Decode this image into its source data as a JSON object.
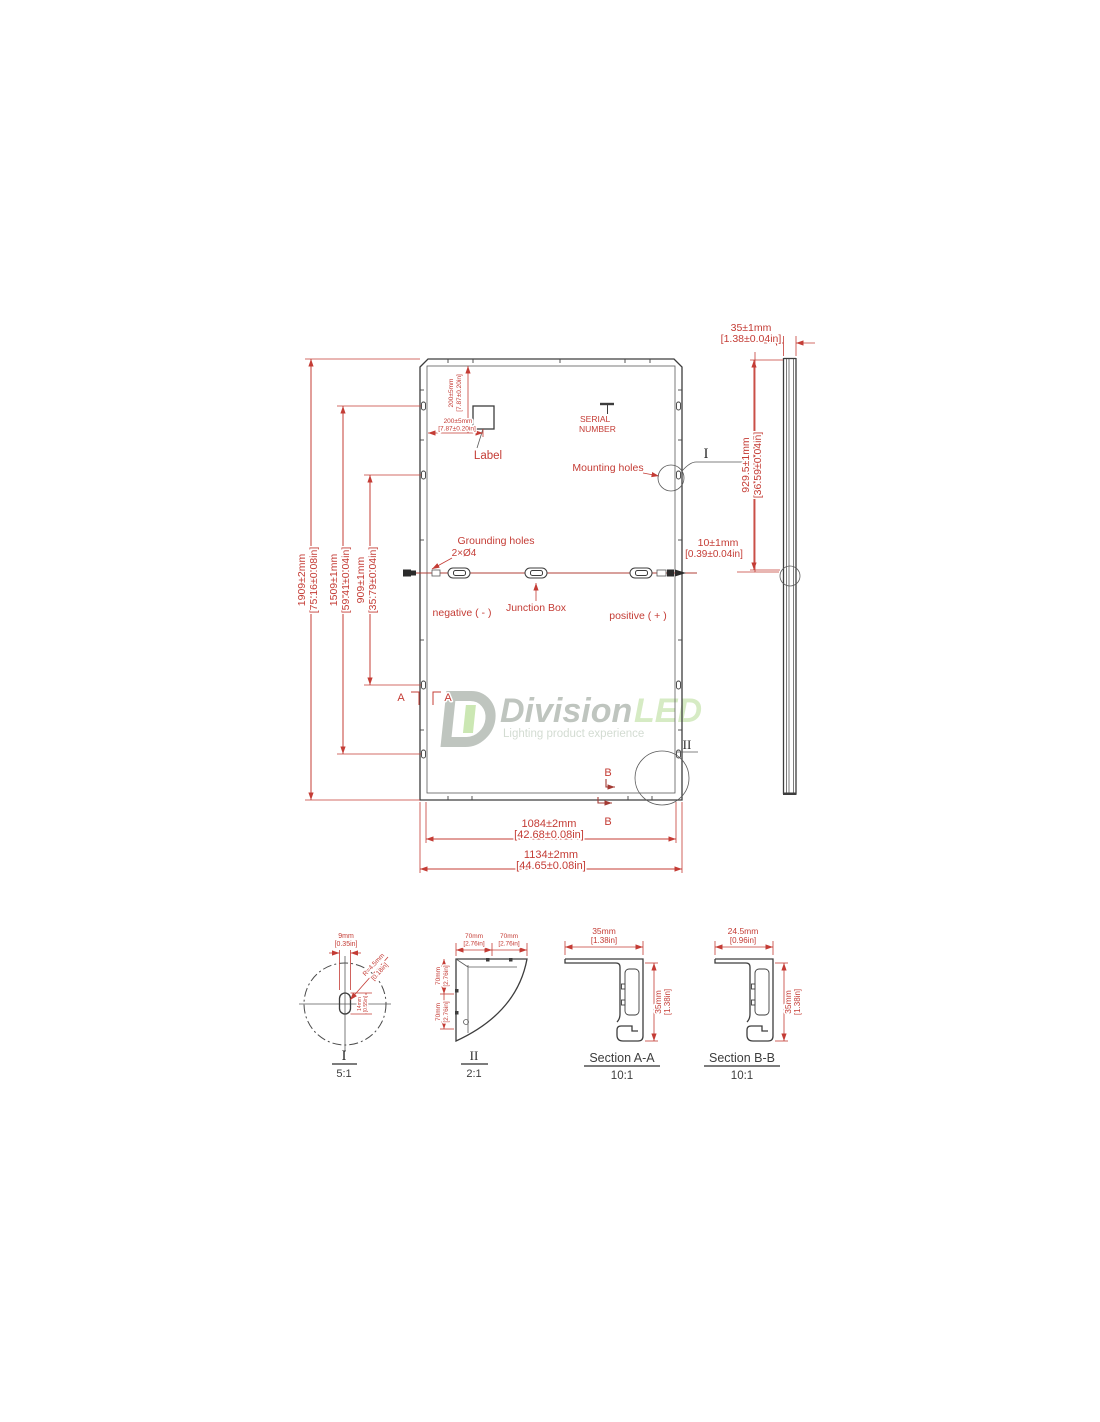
{
  "rear_view": {
    "dims": {
      "height_total_mm": "1909±2mm",
      "height_total_in": "[75.16±0.08in]",
      "height_1509_mm": "1509±1mm",
      "height_1509_in": "[59.41±0.04in]",
      "height_909_mm": "909±1mm",
      "height_909_in": "[35.79±0.04in]",
      "width_total_mm": "1134±2mm",
      "width_total_in": "[44.65±0.08in]",
      "width_inner_mm": "1084±2mm",
      "width_inner_in": "[42.68±0.08in]",
      "label_v_mm": "200±5mm",
      "label_v_in": "[7.87±0.20in]",
      "label_h_mm": "200±5mm",
      "label_h_in": "[7.87±0.20in]",
      "jbox_offset_mm": "10±1mm",
      "jbox_offset_in": "[0.39±0.04in]"
    },
    "labels": {
      "label": "Label",
      "serial_1": "SERIAL",
      "serial_2": "NUMBER",
      "mounting_holes": "Mounting holes",
      "grounding_1": "Grounding holes",
      "grounding_2": "2×Ø4",
      "junction_box": "Junction Box",
      "negative": "negative ( - )",
      "positive": "positive ( + )"
    },
    "markers": {
      "a": "A",
      "b": "B",
      "i": "I",
      "ii": "II"
    }
  },
  "side_view": {
    "thickness_mm": "35±1mm",
    "thickness_in": "[1.38±0.04in]",
    "hole_pos_mm": "929.5±1mm",
    "hole_pos_in": "[36.59±0.04in]"
  },
  "details": {
    "detail_i": {
      "title": "I",
      "scale": "5:1",
      "width_mm": "9mm",
      "width_in": "[0.35in]",
      "radius_mm": "R=4.5mm",
      "radius_in": "[0.18in]",
      "length_mm": "14mm",
      "length_in": "[0.55in]"
    },
    "detail_ii": {
      "title": "II",
      "scale": "2:1",
      "h1_mm": "70mm",
      "h1_in": "[2.76in]",
      "h2_mm": "70mm",
      "h2_in": "[2.76in]",
      "v1_mm": "70mm",
      "v1_in": "[2.76in]",
      "v2_mm": "70mm",
      "v2_in": "[2.76in]"
    },
    "section_aa": {
      "title": "Section A-A",
      "scale": "10:1",
      "width_mm": "35mm",
      "width_in": "[1.38in]",
      "height_mm": "35mm",
      "height_in": "[1.38in]"
    },
    "section_bb": {
      "title": "Section B-B",
      "scale": "10:1",
      "width_mm": "24.5mm",
      "width_in": "[0.96in]",
      "height_mm": "35mm",
      "height_in": "[1.38in]"
    }
  },
  "watermark": {
    "brand_1": "Division",
    "brand_2": "LED",
    "tagline": "Lighting product experience"
  },
  "colors": {
    "dimension_red": "#c43c35",
    "drawing_line": "#3d3d3d",
    "watermark_gray": "#b5bcb5",
    "watermark_green": "#cfe8ba"
  }
}
